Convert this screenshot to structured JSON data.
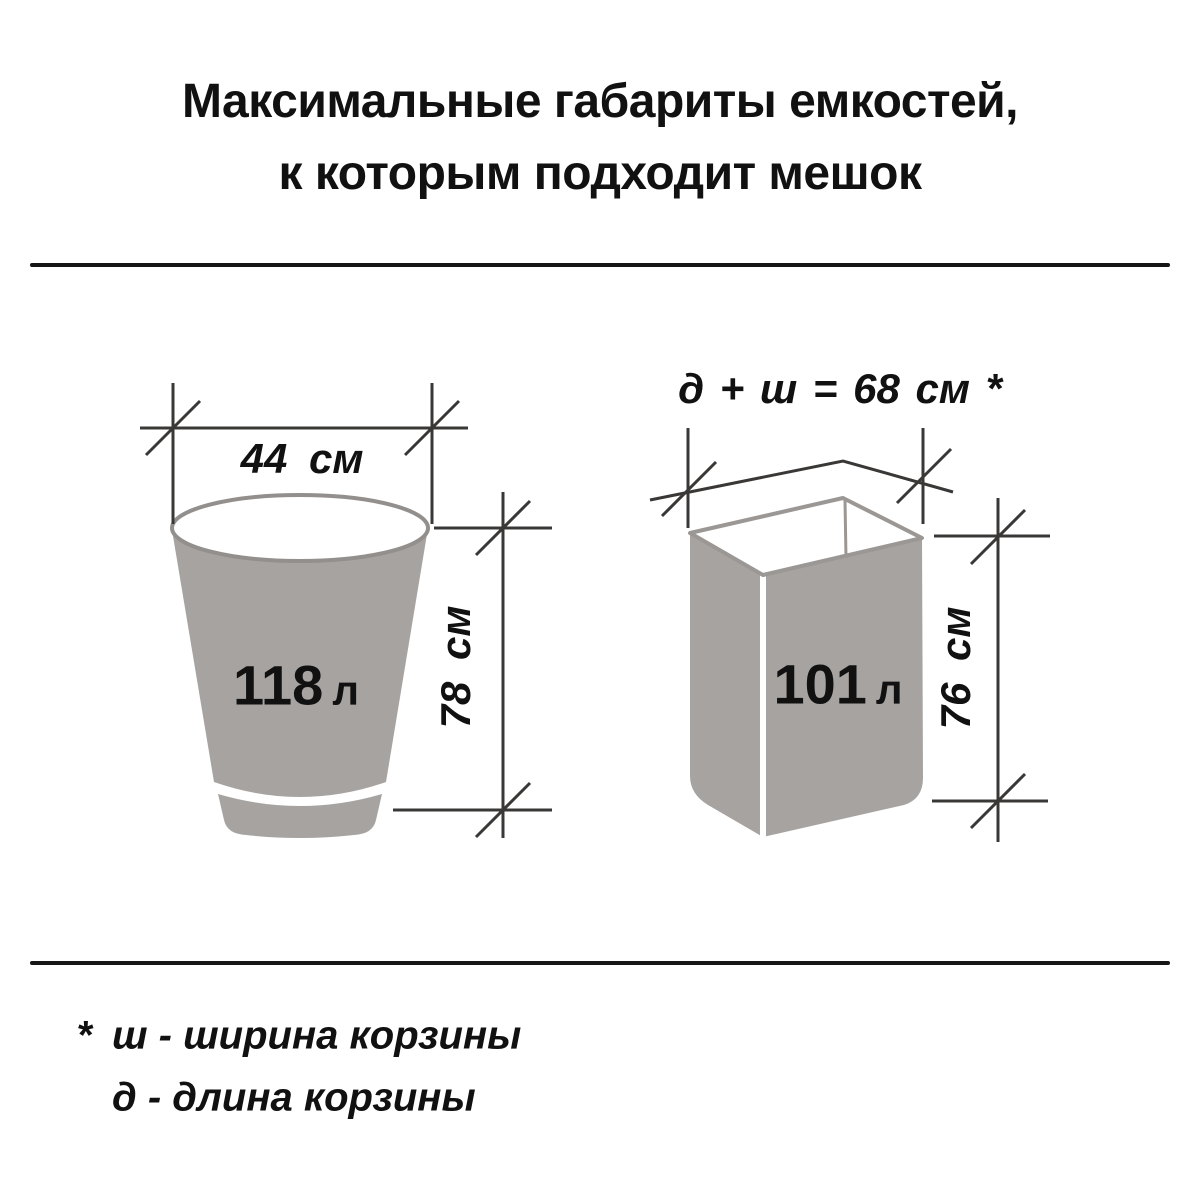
{
  "title": {
    "line1": "Максимальные габариты емкостей,",
    "line2": "к которым подходит мешок"
  },
  "bucket_diagram": {
    "width_label": "44 см",
    "volume_value": "118",
    "volume_unit": "л",
    "height_label": "78 см"
  },
  "box_diagram": {
    "formula_label": "д + ш = 68 см *",
    "volume_value": "101",
    "volume_unit": "л",
    "height_label": "76 см"
  },
  "footnote": {
    "marker": "*",
    "line1": "ш - ширина корзины",
    "line2": "д - длина корзины"
  },
  "colors": {
    "background": "#ffffff",
    "container_fill": "#a7a3a1",
    "container_stroke": "#938f8c",
    "opening_stroke": "#9b9794",
    "dimension_line": "#3a3836",
    "text": "#111111"
  }
}
